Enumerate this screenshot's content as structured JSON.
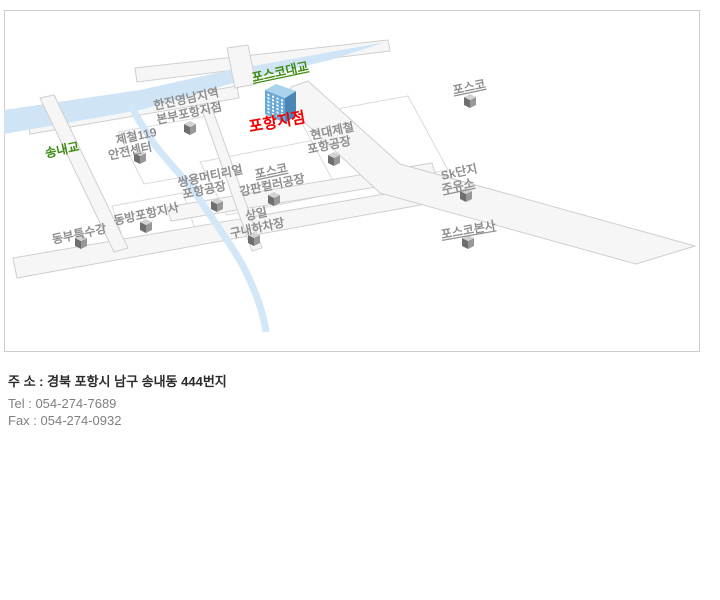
{
  "map": {
    "bridge_labels": {
      "posco_bridge": "포스코대교",
      "songnae_bridge": "송내교"
    },
    "marker": {
      "label": "포항지점"
    },
    "labels": [
      {
        "name": "hanjin",
        "lines": [
          "한진영남지역",
          "본부포항지점"
        ]
      },
      {
        "name": "jecheol",
        "lines": [
          "제철119",
          "안전센터"
        ]
      },
      {
        "name": "hyundai",
        "lines": [
          "현대제철",
          "포항공장"
        ]
      },
      {
        "name": "posco-top",
        "lines": [
          "포스코"
        ]
      },
      {
        "name": "ssangyong",
        "lines": [
          "쌍용머티리얼",
          "포항공장"
        ]
      },
      {
        "name": "gangpan",
        "lines": [
          "포스코",
          "강판컬러공장"
        ]
      },
      {
        "name": "sangil",
        "lines": [
          "상일",
          "구내하차장"
        ]
      },
      {
        "name": "sk",
        "lines": [
          "Sk단지",
          "주유소"
        ]
      },
      {
        "name": "bonsa",
        "lines": [
          "포스코본사"
        ]
      },
      {
        "name": "dongbang",
        "lines": [
          "동방포항지사"
        ]
      },
      {
        "name": "dongbu",
        "lines": [
          "동부특수강"
        ]
      }
    ],
    "colors": {
      "river": "#cfe4f4",
      "road_fill": "#f6f6f6",
      "road_stroke": "#cfcfcf",
      "label_gray": "#8f8f8f",
      "bridge_green": "#3f8c14",
      "marker_red": "#f40000",
      "building_front": "#68a9d6",
      "building_side": "#4b85b5",
      "building_roof": "#a9d4ec"
    }
  },
  "info": {
    "address": "주 소 : 경북 포항시 남구 송내동 444번지",
    "tel": "Tel : 054-274-7689",
    "fax": "Fax : 054-274-0932"
  }
}
